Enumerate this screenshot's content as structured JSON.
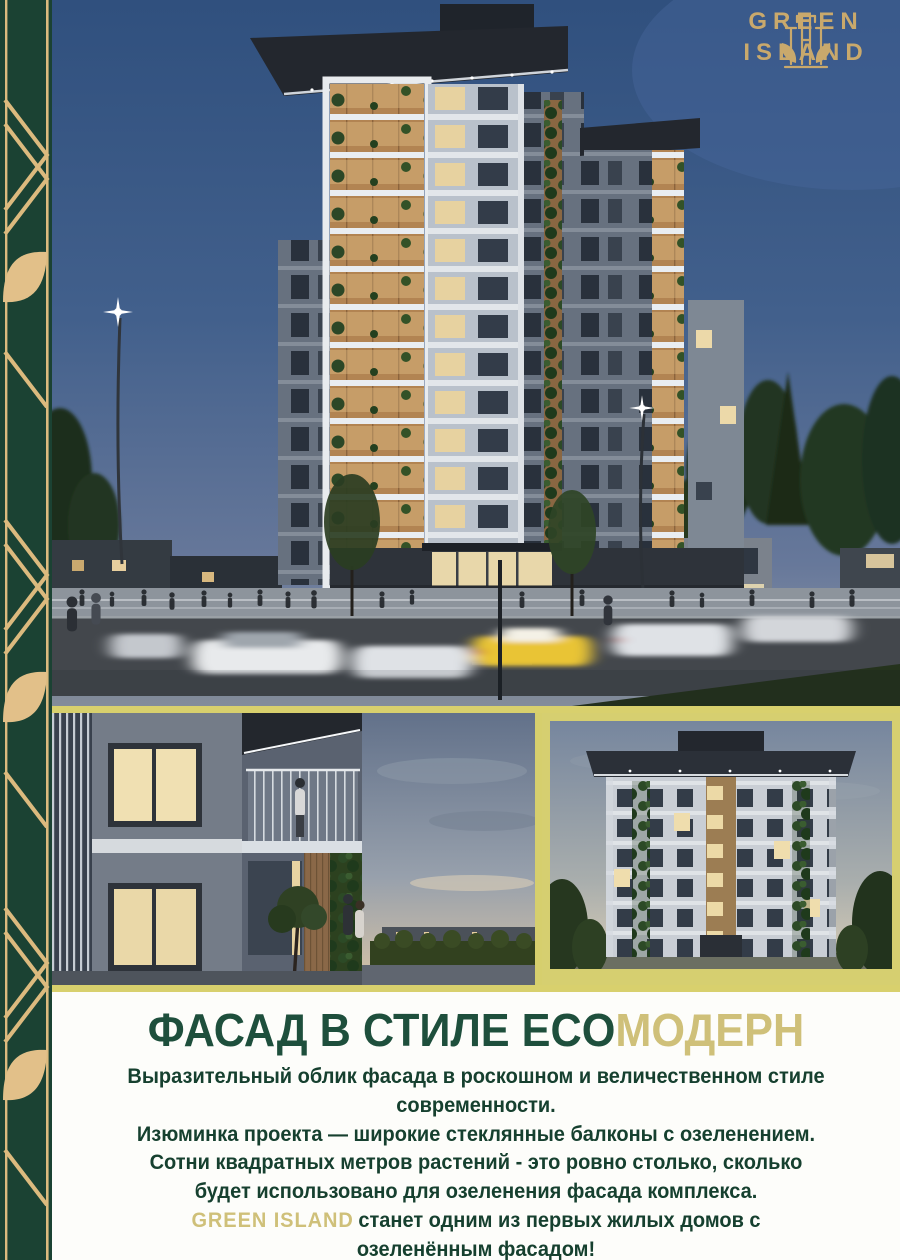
{
  "brand": {
    "line1": "GREEN",
    "line2": "ISLAND"
  },
  "headline": {
    "green_part": "ФАСАД В СТИЛЕ ECO",
    "gold_part": "МОДЕРН"
  },
  "body": {
    "lines": [
      "Выразительный облик фасада в роскошном  и величественном стиле",
      "современности.",
      "Изюминка проекта — широкие стеклянные  балконы с озеленением.",
      "Сотни квадратных метров  растений  -  это ровно столько, сколько",
      "будет использовано для озеленения фасада комплекса."
    ],
    "highlight_line": {
      "brand": "GREEN ISLAND",
      "rest": "станет одним из  первых жилых домов с"
    },
    "last_line": "озеленённым фасадом!"
  },
  "colors": {
    "sidebar_green": "#1b4233",
    "decor_gold": "#dcba7e",
    "divider_khaki": "#d8d06d",
    "frame_khaki": "#d6cf70",
    "headline_green": "#1e4f3c",
    "headline_gold": "#cfc079",
    "body_green": "#16402f",
    "logo_gold": "#c9a96c"
  }
}
